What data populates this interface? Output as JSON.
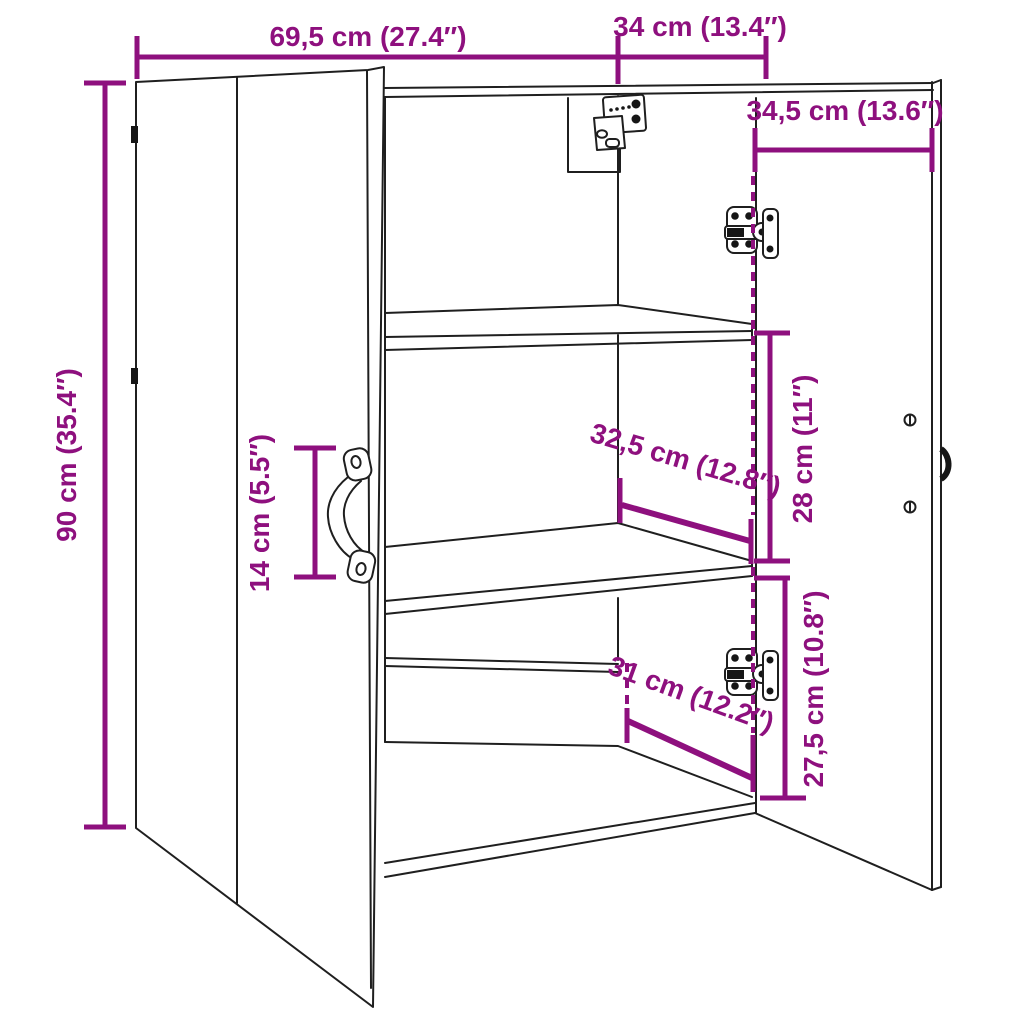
{
  "diagram": {
    "type": "furniture-dimension-drawing",
    "subject": "two-door wall cabinet with two shelves, doors open",
    "background_color": "#ffffff",
    "line_color": "#1f1f1f",
    "dimension_color": "#8e107e",
    "dimensions": {
      "top_width": "69,5 cm (27.4″)",
      "top_depth": "34 cm (13.4″)",
      "door_width": "34,5 cm (13.6″)",
      "height": "90 cm (35.4″)",
      "handle_length": "14 cm (5.5″)",
      "upper_shelf_depth": "32,5 cm (12.8″)",
      "upper_compartment_height": "28 cm (11″)",
      "lower_shelf_depth": "31 cm (12.2″)",
      "lower_compartment_height": "27,5 cm (10.8″)"
    }
  }
}
